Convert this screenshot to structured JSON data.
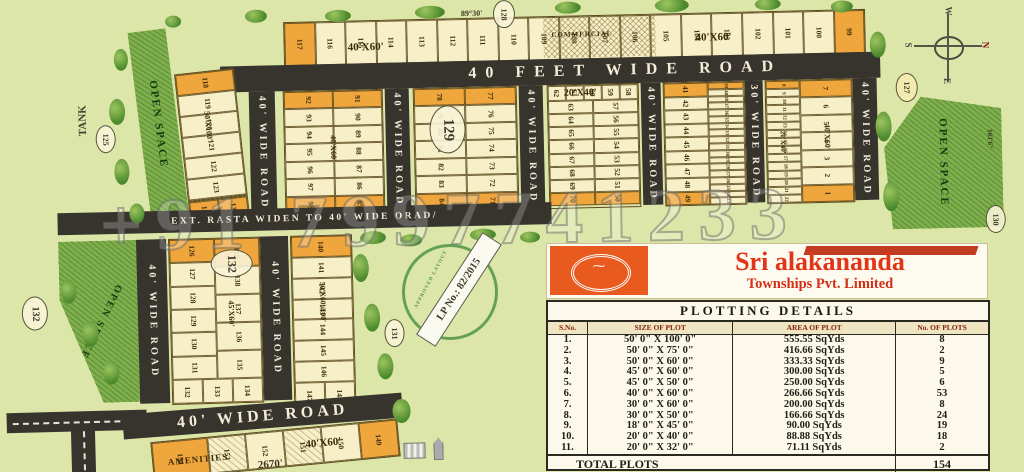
{
  "watermark": "+91 7997741233",
  "compass": {
    "n": "N",
    "s": "S",
    "e": "E",
    "w": "W"
  },
  "roads": {
    "top": "40 FEET WIDE ROAD",
    "v40": "40' WIDE ROAD",
    "v30": "30' WIDE ROAD",
    "ext_rasta": "EXT. RASTA WIDEN TO 40' WIDE ORAD/",
    "bottom": "40' WIDE ROAD"
  },
  "labels": {
    "open_space": "OPEN SPACE",
    "tank": "TANK",
    "commercial": "COMMERCIAL",
    "amenities": "AMENITIES",
    "size_50x100": "50'X100'",
    "size_40x60": "40'X60'",
    "size_20x40": "20'X40'",
    "size_45x60": "45'X60'",
    "size_50x60_100": "50'X60'/100'"
  },
  "dims": {
    "d8930": "89°30'",
    "d1036": "103'6\"",
    "d2670": "2670'"
  },
  "markers": {
    "m125": "125",
    "m127": "127",
    "m128": "128",
    "m129": "129",
    "m130": "130",
    "m131": "131",
    "m132": "132",
    "m132b": "132"
  },
  "stamp": {
    "vuda": "VUDA",
    "approved": "APPROVED LAYOUT",
    "lp": "LP No.: 82/2015"
  },
  "brand": {
    "title": "Sri alakananda",
    "subtitle": "Townships Pvt. Limited"
  },
  "plots": {
    "top_row": [
      "117",
      "116",
      "115",
      "114",
      "113",
      "112",
      "111",
      "110",
      "109",
      "108",
      "107",
      "106",
      "105",
      "104",
      "103",
      "102",
      "101",
      "100",
      "99"
    ],
    "col118": [
      "118",
      "119",
      "120",
      "121",
      "122",
      "123"
    ],
    "col118_bottom": [
      "125",
      "124"
    ],
    "blockA_left": [
      "92",
      "93",
      "94",
      "95",
      "96",
      "97",
      "98"
    ],
    "blockA_right": [
      "91",
      "90",
      "89",
      "88",
      "87",
      "86",
      "85"
    ],
    "blockB_left": [
      "78",
      "79",
      "80",
      "81",
      "82",
      "83",
      "84"
    ],
    "blockB_right": [
      "77",
      "76",
      "75",
      "74",
      "73",
      "72",
      "71"
    ],
    "blockC_top": [
      "62",
      "61",
      "60",
      "59",
      "58"
    ],
    "blockC_left": [
      "63",
      "64",
      "65",
      "66",
      "67",
      "68",
      "69",
      "70"
    ],
    "blockC_right": [
      "57",
      "56",
      "55",
      "54",
      "53",
      "52",
      "51",
      "50"
    ],
    "blockD_left": [
      "41",
      "42",
      "43",
      "44",
      "45",
      "46",
      "47",
      "48",
      "49"
    ],
    "blockD_strip": [
      "39",
      "40",
      "38",
      "37",
      "36",
      "35",
      "34",
      "33",
      "32",
      "31",
      "30",
      "29",
      "28",
      "27",
      "26",
      "25",
      "24",
      "23"
    ],
    "blockE_strip": [
      "8",
      "9",
      "10",
      "11",
      "12",
      "13",
      "14",
      "15",
      "16",
      "17",
      "18",
      "19",
      "20",
      "21",
      "22"
    ],
    "blockE_right": [
      "7",
      "6",
      "5",
      "4",
      "3",
      "2",
      "1"
    ],
    "lower1_left": [
      "126",
      "127",
      "128",
      "129",
      "130",
      "131"
    ],
    "lower1_right": [
      "139",
      "138",
      "137",
      "136",
      "135"
    ],
    "lower1_bottom": [
      "132",
      "133",
      "134"
    ],
    "lower2": [
      "140",
      "141",
      "142",
      "143",
      "144",
      "145",
      "146"
    ],
    "lower2_bottom": [
      "147",
      "148"
    ],
    "amenities_row": [
      "154",
      "153",
      "152",
      "151",
      "150",
      "149"
    ]
  },
  "table": {
    "title": "PLOTTING DETAILS",
    "headers": [
      "S.No.",
      "SIZE OF PLOT",
      "AREA OF PLOT",
      "No. OF PLOTS"
    ],
    "rows": [
      [
        "1.",
        "50' 0\" X 100' 0\"",
        "555.55 SqYds",
        "8"
      ],
      [
        "2.",
        "50' 0\" X 75' 0\"",
        "416.66 SqYds",
        "2"
      ],
      [
        "3.",
        "50' 0\" X 60' 0\"",
        "333.33 SqYds",
        "9"
      ],
      [
        "4.",
        "45' 0\" X 60' 0\"",
        "300.00 SqYds",
        "5"
      ],
      [
        "5.",
        "45' 0\" X 50' 0\"",
        "250.00 SqYds",
        "6"
      ],
      [
        "6.",
        "40' 0\" X 60' 0\"",
        "266.66 SqYds",
        "53"
      ],
      [
        "7.",
        "30' 0\" X 60' 0\"",
        "200.00 SqYds",
        "8"
      ],
      [
        "8.",
        "30' 0\" X 50' 0\"",
        "166.66 SqYds",
        "24"
      ],
      [
        "9.",
        "18' 0\" X 45' 0\"",
        "90.00 SqYds",
        "19"
      ],
      [
        "10.",
        "20' 0\" X 40' 0\"",
        "88.88 SqYds",
        "18"
      ],
      [
        "11.",
        "20' 0\" X 32' 0\"",
        "71.11 SqYds",
        "2"
      ]
    ],
    "total_label": "TOTAL PLOTS",
    "total_value": "154"
  }
}
